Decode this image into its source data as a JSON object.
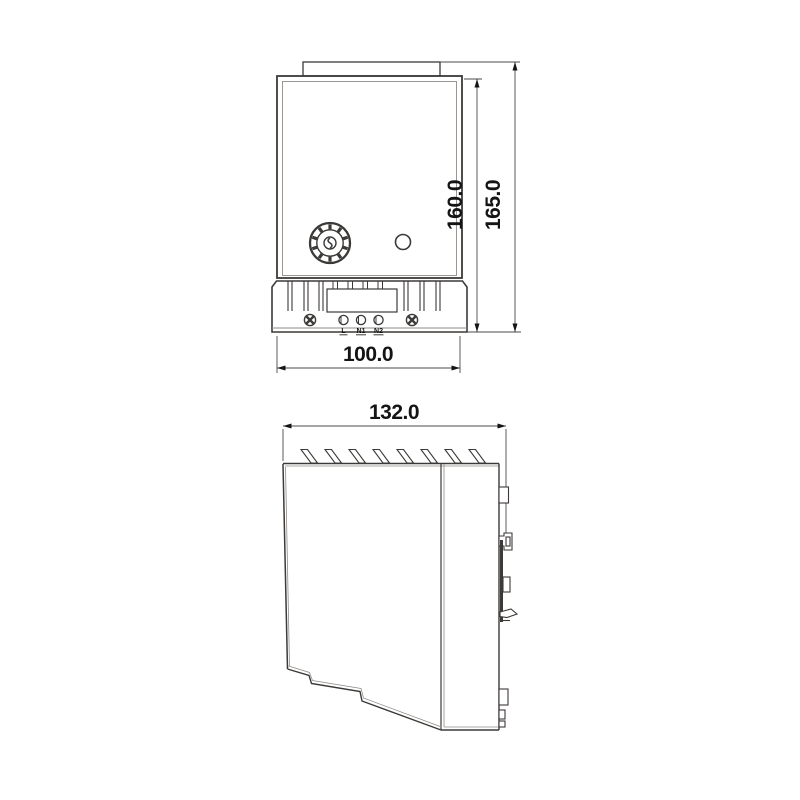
{
  "drawing": {
    "type": "technical-dimension-drawing",
    "background": "#ffffff",
    "line_color": "#3c3a38",
    "secondary_line_color": "#8f8b88",
    "front_view": {
      "dim_height_inner": "160.0",
      "dim_height_outer": "165.0",
      "dim_width": "100.0",
      "terminal_labels": [
        "L",
        "N1",
        "N2"
      ]
    },
    "side_view": {
      "dim_depth": "132.0"
    }
  }
}
